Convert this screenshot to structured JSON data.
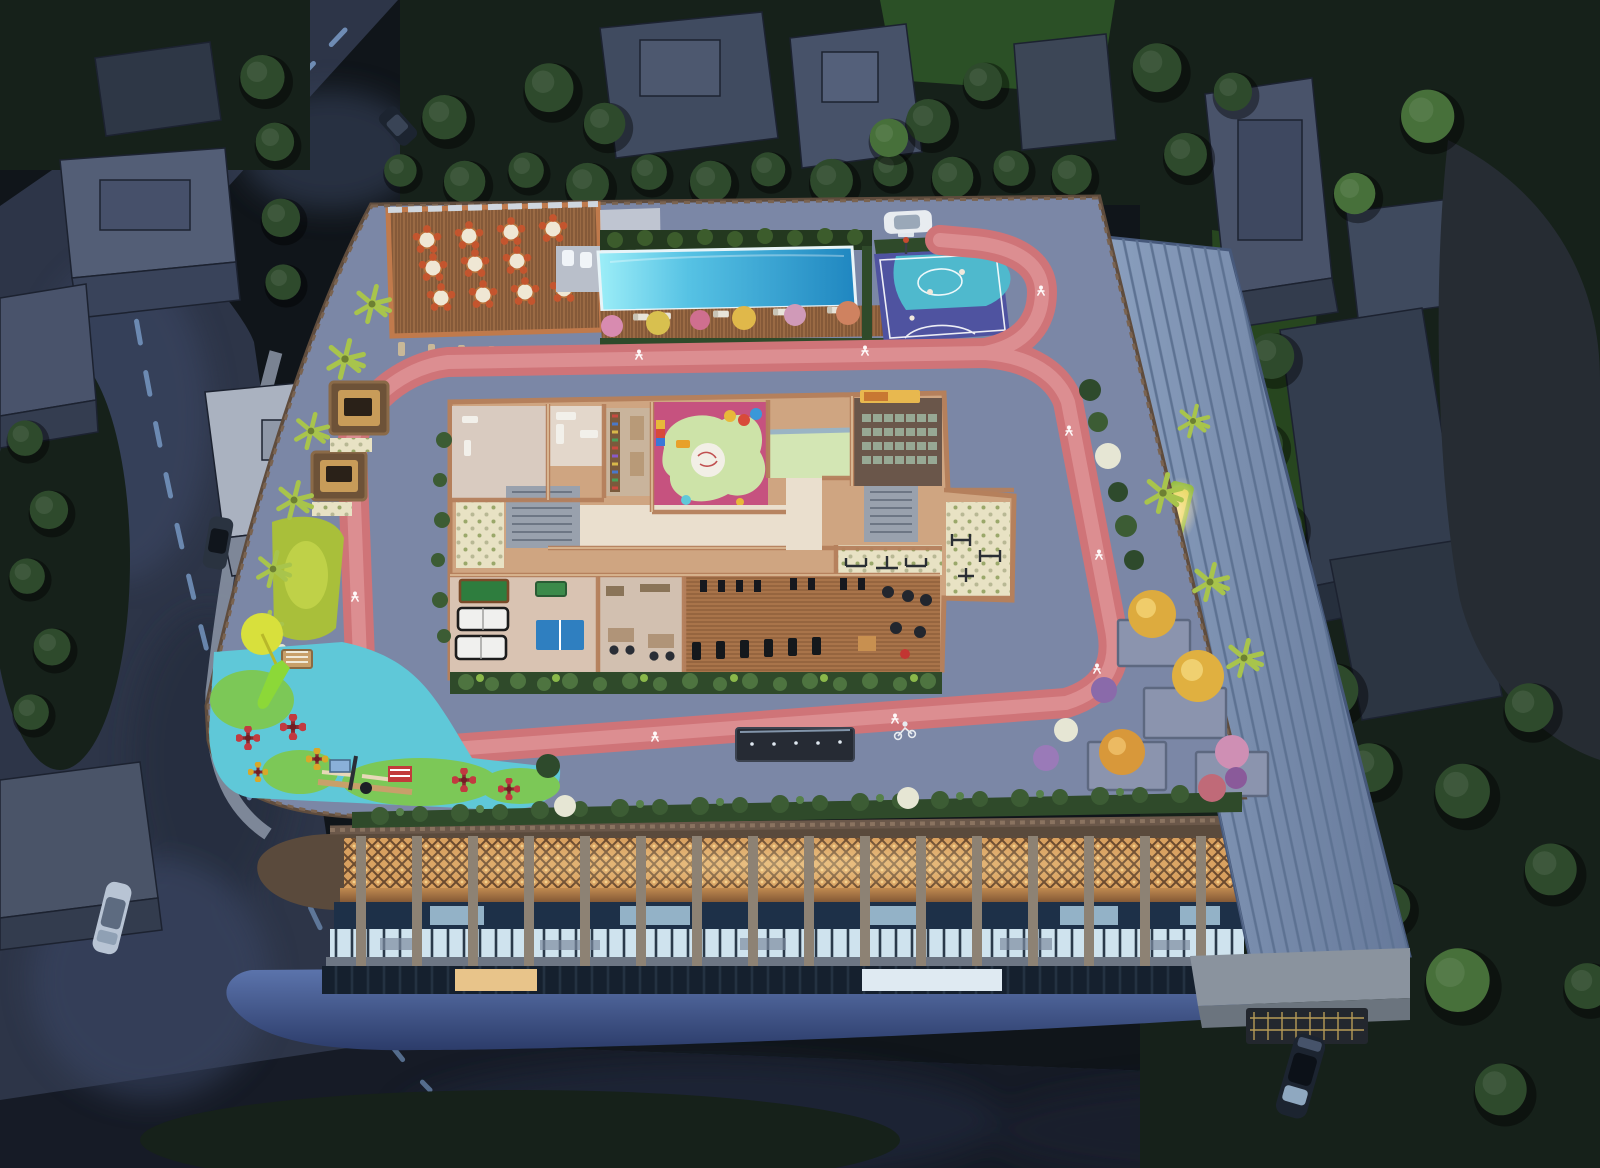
{
  "scene": {
    "type": "aerial-dusk-architectural-render",
    "features": [
      "jogging-track",
      "swimming-pool",
      "basketball-half-court",
      "restaurant-deck",
      "clubhouse-floorplan",
      "kids-play-area",
      "mini-theater",
      "gym",
      "games-room",
      "playground",
      "pergola-swings",
      "lawn",
      "planter-garden",
      "metal-roof",
      "entrance-canopy",
      "surrounding-streets",
      "neighbor-buildings",
      "trees",
      "cars"
    ]
  },
  "palette": {
    "bg": "#10151a",
    "asphalt": "#2d3548",
    "asphalt_dark": "#161b26",
    "lane": "#7fa3d0",
    "sidewalk": "#8d97a8",
    "tree_dark": "#16211a",
    "tree_mid": "#2e4a2c",
    "tree_bright": "#47703a",
    "lawn_bright": "#a9bf3a",
    "lawn_dark": "#2b5026",
    "bldg_roof": "#535e76",
    "bldg_face": "#39435a",
    "rock": "#262c33",
    "deck": "#7b87a6",
    "deck_light": "#8b95b5",
    "parapet": "#5f4c3d",
    "track": "#cf7478",
    "track_hi": "#e09799",
    "pool_shallow": "#8ee4f4",
    "pool_deep": "#1f86c0",
    "pool_deck": "#a06a42",
    "court": "#4f53a0",
    "court_key": "#4fb9cd",
    "rest_wood": "#9a6a44",
    "chair": "#c4552e",
    "table_top": "#efe7d4",
    "wall_tan": "#c08a64",
    "room_floor": "#d9cbc0",
    "kids_pink": "#c6527f",
    "kids_path": "#cde3a8",
    "hall_green": "#d3e6b4",
    "theater_wall": "#6a564a",
    "seat_green": "#97a894",
    "screen_gold": "#e8b84f",
    "billiard": "#2e7d3e",
    "tabletennis": "#2f7fc0",
    "gym_wood": "#a9744a",
    "stair_grey": "#99a1ad",
    "play_cyan": "#5fc8d8",
    "play_green": "#7cc857",
    "umbrella": "#d8e03c",
    "slide": "#8cd838",
    "spinner": "#c23a40",
    "pergola_glow": "#d8a95f",
    "flower_yellow": "#ddab3e",
    "flower_pink": "#cf8fb4",
    "flower_white": "#e6e6d4",
    "palm": "#a8c44c",
    "lattice": "#d8a05f",
    "lattice_deep": "#6b4a2e",
    "facade_col": "#8d8274",
    "glass_dark": "#1d3048",
    "glass_lit": "#cfe3ee",
    "warm_window": "#e8c48a",
    "slab": "#6d7684",
    "skirt_top": "#6079b2",
    "skirt_bot": "#35497e",
    "roof_metal": "#7e93b2",
    "roof_seam": "#5d7292",
    "canopy": "#8a939e",
    "canopy_face": "#6b747e",
    "gate": "#23272e",
    "gold": "#c8a85c",
    "car_dark": "#1c2430",
    "car_silver": "#b8c4d4",
    "suv_white": "#e8ecf0",
    "hedge": "#2f4a2a"
  }
}
